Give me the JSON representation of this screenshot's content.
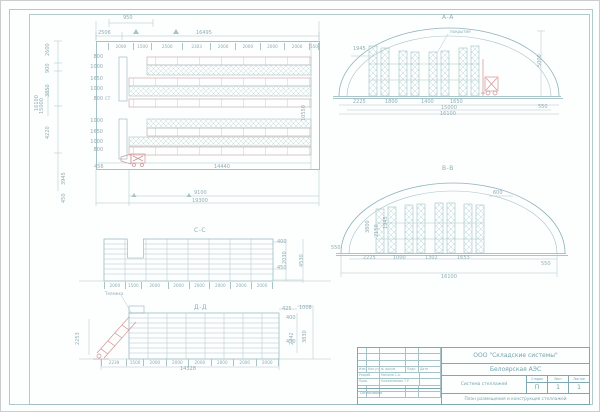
{
  "plan": {
    "d950": "950",
    "d2506": "2506",
    "d16495": "16495",
    "segments": [
      "2000",
      "1500",
      "2500",
      "2303",
      "2000",
      "2000",
      "2000",
      "2000",
      "550"
    ],
    "left_dims": [
      "2600",
      "900",
      "3850",
      "4220"
    ],
    "d3945": "3945",
    "d450": "450",
    "d16100": "16100",
    "d15000": "15000",
    "rows": [
      "800",
      "1000",
      "1650",
      "1000",
      "800",
      "1000",
      "1650",
      "1000",
      "800"
    ],
    "st": "СТ",
    "d456": "456",
    "d14440": "14440",
    "d10550": "10550",
    "d9100": "9100",
    "d19300": "19300"
  },
  "aa": {
    "title": "А-А",
    "callout": "покрытие",
    "d1945": "1945",
    "d5000": "5000",
    "b": [
      "2225",
      "1800",
      "1400",
      "1650"
    ],
    "d15000": "15000",
    "d16100": "16100",
    "d550": "550"
  },
  "bb": {
    "title": "В-В",
    "left550": "550",
    "right550": "550",
    "d600": "600",
    "r": [
      "3800",
      "2150",
      "1945"
    ],
    "b": [
      "2225",
      "1000",
      "1302",
      "1653"
    ],
    "d16100": "16100"
  },
  "cc": {
    "title": "С-С",
    "d400": "400",
    "d450": "450",
    "d2030": "2030",
    "d4530": "4530",
    "seg": [
      "2000",
      "1500",
      "2600",
      "2000",
      "2000",
      "2000",
      "2000",
      "2000"
    ],
    "callout": "Тележка"
  },
  "dd": {
    "title": "Д-Д",
    "d2253": "2253",
    "seg": [
      "2239",
      "1500",
      "2000",
      "2000",
      "2000",
      "2000",
      "2000",
      "2000"
    ],
    "d14328": "14328",
    "d425": "425",
    "d1008": "1008",
    "d400": "400",
    "d430": "430",
    "d2242": "2242",
    "d3830": "3830"
  },
  "tb": {
    "company": "ООО \"Складские системы\"",
    "object": "Белоярская АЭС",
    "doc_name": "Система стеллажей",
    "stage_headers": [
      "Стадия",
      "Лист",
      "Листов"
    ],
    "stage_values": [
      "П",
      "1",
      "1"
    ],
    "sheet_title": "План размещения и конструкция стеллажей",
    "header_cells": [
      "Изм.",
      "Кол.уч.",
      "№ докум.",
      "Подп.",
      "Дата"
    ],
    "row1_label": "Разраб.",
    "row1_name": "Минина С.А.",
    "row2_label": "Пров.",
    "row2_name": "Кожевникова Т.Р.",
    "approved": "Согласовано"
  }
}
